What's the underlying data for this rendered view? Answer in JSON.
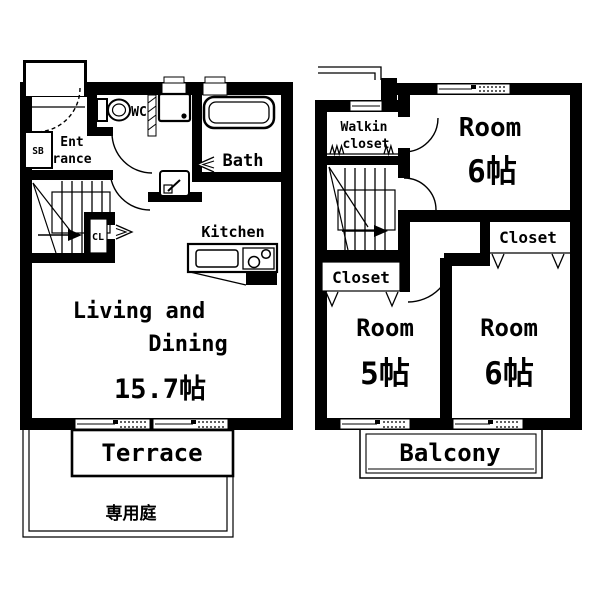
{
  "title": "2-story apartment floor plan",
  "colors": {
    "line": "#000000",
    "background": "#ffffff"
  },
  "floor1": {
    "entrance_line1": "Ent",
    "entrance_line2": "rance",
    "shoe_box": "SB",
    "wc": "WC",
    "bath": "Bath",
    "kitchen": "Kitchen",
    "closet": "CL",
    "living_line1": "Living and",
    "living_line2": "Dining",
    "living_size": "15.7帖",
    "terrace": "Terrace",
    "garden": "専用庭"
  },
  "floor2": {
    "walkin_line1": "Walkin",
    "walkin_line2": "closet",
    "room_ne_label": "Room",
    "room_ne_size": "6帖",
    "closet_east": "Closet",
    "closet_west": "Closet",
    "room_sw_label": "Room",
    "room_sw_size": "5帖",
    "room_se_label": "Room",
    "room_se_size": "6帖",
    "balcony": "Balcony"
  }
}
